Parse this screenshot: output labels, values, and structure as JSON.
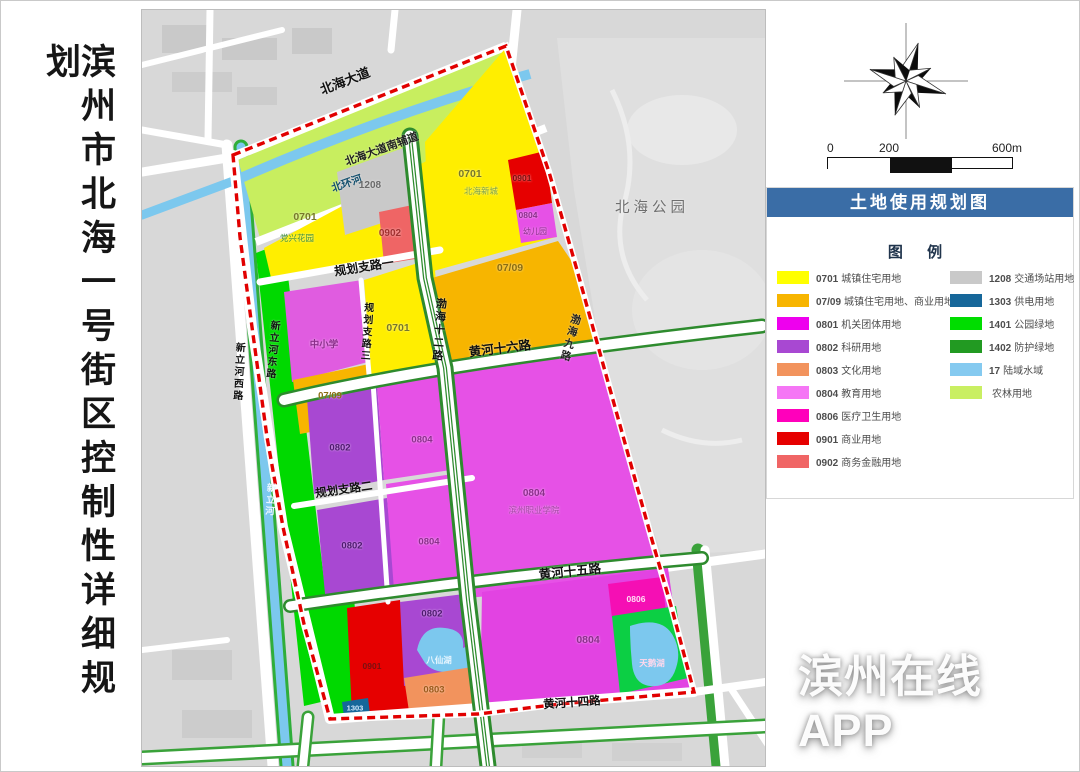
{
  "title": "滨州市北海一号街区控制性详细规划",
  "watermark": "滨州在线APP",
  "scale": {
    "ticks": [
      "0",
      "200",
      "600m"
    ]
  },
  "legend": {
    "title": "土地使用规划图",
    "caption": "图 例",
    "left": [
      {
        "code": "0701",
        "label": "城镇住宅用地",
        "color": "#ffff00"
      },
      {
        "code": "07/09",
        "label": "城镇住宅用地、商业用地",
        "color": "#f7b500"
      },
      {
        "code": "0801",
        "label": "机关团体用地",
        "color": "#ee00ee"
      },
      {
        "code": "0802",
        "label": "科研用地",
        "color": "#a848d2"
      },
      {
        "code": "0803",
        "label": "文化用地",
        "color": "#f2935d"
      },
      {
        "code": "0804",
        "label": "教育用地",
        "color": "#f576f5"
      },
      {
        "code": "0806",
        "label": "医疗卫生用地",
        "color": "#ff00bb"
      },
      {
        "code": "0901",
        "label": "商业用地",
        "color": "#e60000"
      },
      {
        "code": "0902",
        "label": "商务金融用地",
        "color": "#f06565"
      }
    ],
    "right": [
      {
        "code": "1208",
        "label": "交通场站用地",
        "color": "#c9c9c9"
      },
      {
        "code": "1303",
        "label": "供电用地",
        "color": "#16679a"
      },
      {
        "code": "1401",
        "label": "公园绿地",
        "color": "#00dd00"
      },
      {
        "code": "1402",
        "label": "防护绿地",
        "color": "#229a22"
      },
      {
        "code": "17",
        "label": "陆域水域",
        "color": "#85caf0"
      },
      {
        "code": "",
        "label": "农林用地",
        "color": "#c9ef62"
      }
    ],
    "header_bg": "#3a6da6"
  },
  "map": {
    "roads": {
      "beihai_avenue": "北海大道",
      "beihuan_river": "北环河",
      "south_service_road": "北海大道南辅道",
      "planning_branch_1": "规划支路一",
      "planning_branch_2": "规划支路二",
      "planning_branch_3": "规划支路三",
      "bohai_12": "渤海十二路",
      "bohai_9": "渤海九路",
      "huanghe_16": "黄河十六路",
      "huanghe_15": "黄河十五路",
      "huanghe_14": "黄河十四路",
      "xinli_west": "新立河西路",
      "xinli_east": "新立河东路",
      "xinli_river": "新立河"
    },
    "zones": {
      "residential_a": {
        "code": "0701",
        "name": "党兴花园"
      },
      "transport": {
        "code": "1208"
      },
      "business_finance": {
        "code": "0902"
      },
      "residential_b": {
        "code": "0701",
        "name": "北海新城"
      },
      "commercial_a": {
        "code": "0901"
      },
      "kindergarten": {
        "code": "0804",
        "name": "幼儿园"
      },
      "mixed_a": {
        "code": "07/09"
      },
      "school": {
        "name": "中小学"
      },
      "mixed_b": {
        "code": "07/09"
      },
      "residential_c": {
        "code": "0701"
      },
      "research_a": {
        "code": "0802"
      },
      "research_b": {
        "code": "0802"
      },
      "education_a": {
        "code": "0804"
      },
      "education_b": {
        "code": "0804"
      },
      "college": {
        "code": "0804",
        "name": "滨州职业学院"
      },
      "commercial_b": {
        "code": "0901"
      },
      "power": {
        "code": "1303"
      },
      "research_c": {
        "code": "0802"
      },
      "baxian_lake": "八仙湖",
      "culture": {
        "code": "0803"
      },
      "education_c": {
        "code": "0804"
      },
      "medical": {
        "code": "0806"
      },
      "swan_lake": "天鹅湖"
    },
    "landmarks": {
      "park": "北海公园"
    },
    "boundary_color": "#e10000"
  }
}
